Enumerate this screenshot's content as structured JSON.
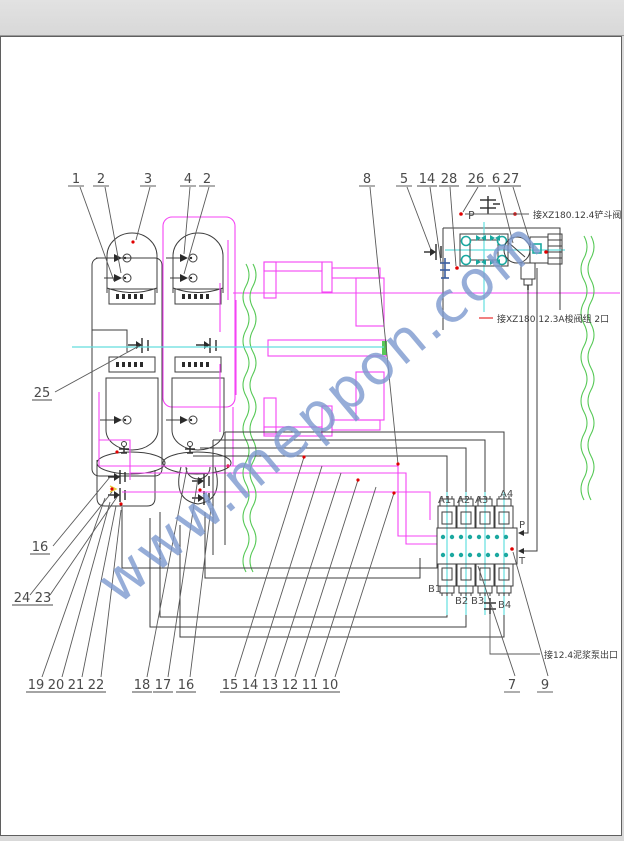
{
  "page": {
    "background": "#ffffff",
    "outer_background": "#d9d9d9",
    "border_color": "#5f5f5f"
  },
  "watermark": {
    "text": "www.meppon.com",
    "color": "#7d99cf"
  },
  "colors": {
    "line_black": "#3d3d3d",
    "pipe_magenta": "#f444f4",
    "break_green": "#57c957",
    "centerline_cyan": "#63dede",
    "port_teal": "#1ba8a0",
    "marker_red": "#e00000",
    "fitting_blue": "#3c5fa0",
    "mark_yellow": "#e8d03c"
  },
  "callouts": {
    "top": [
      "1",
      "2",
      "3",
      "4",
      "2",
      "8",
      "5",
      "14",
      "28",
      "26",
      "6",
      "27"
    ],
    "mid": [
      "25",
      "16",
      "24",
      "23"
    ],
    "bottom": [
      "19",
      "20",
      "21",
      "22",
      "18",
      "17",
      "16",
      "15",
      "14",
      "13",
      "12",
      "11",
      "10",
      "7",
      "9"
    ]
  },
  "annotations": {
    "valve_p1": "接XZ180.12.4铲斗阀 P1口",
    "shuttle_2": "接XZ180.12.3A梭阀组 2口",
    "pump_out": "接12.4泥浆泵出口"
  },
  "pilot_valve": {
    "p": "P"
  },
  "manifold": {
    "ports_top": [
      "A1",
      "A2",
      "A3",
      "A4"
    ],
    "ports_bottom": [
      "B1",
      "B2",
      "B3",
      "B4"
    ],
    "p": "P",
    "t": "T"
  }
}
